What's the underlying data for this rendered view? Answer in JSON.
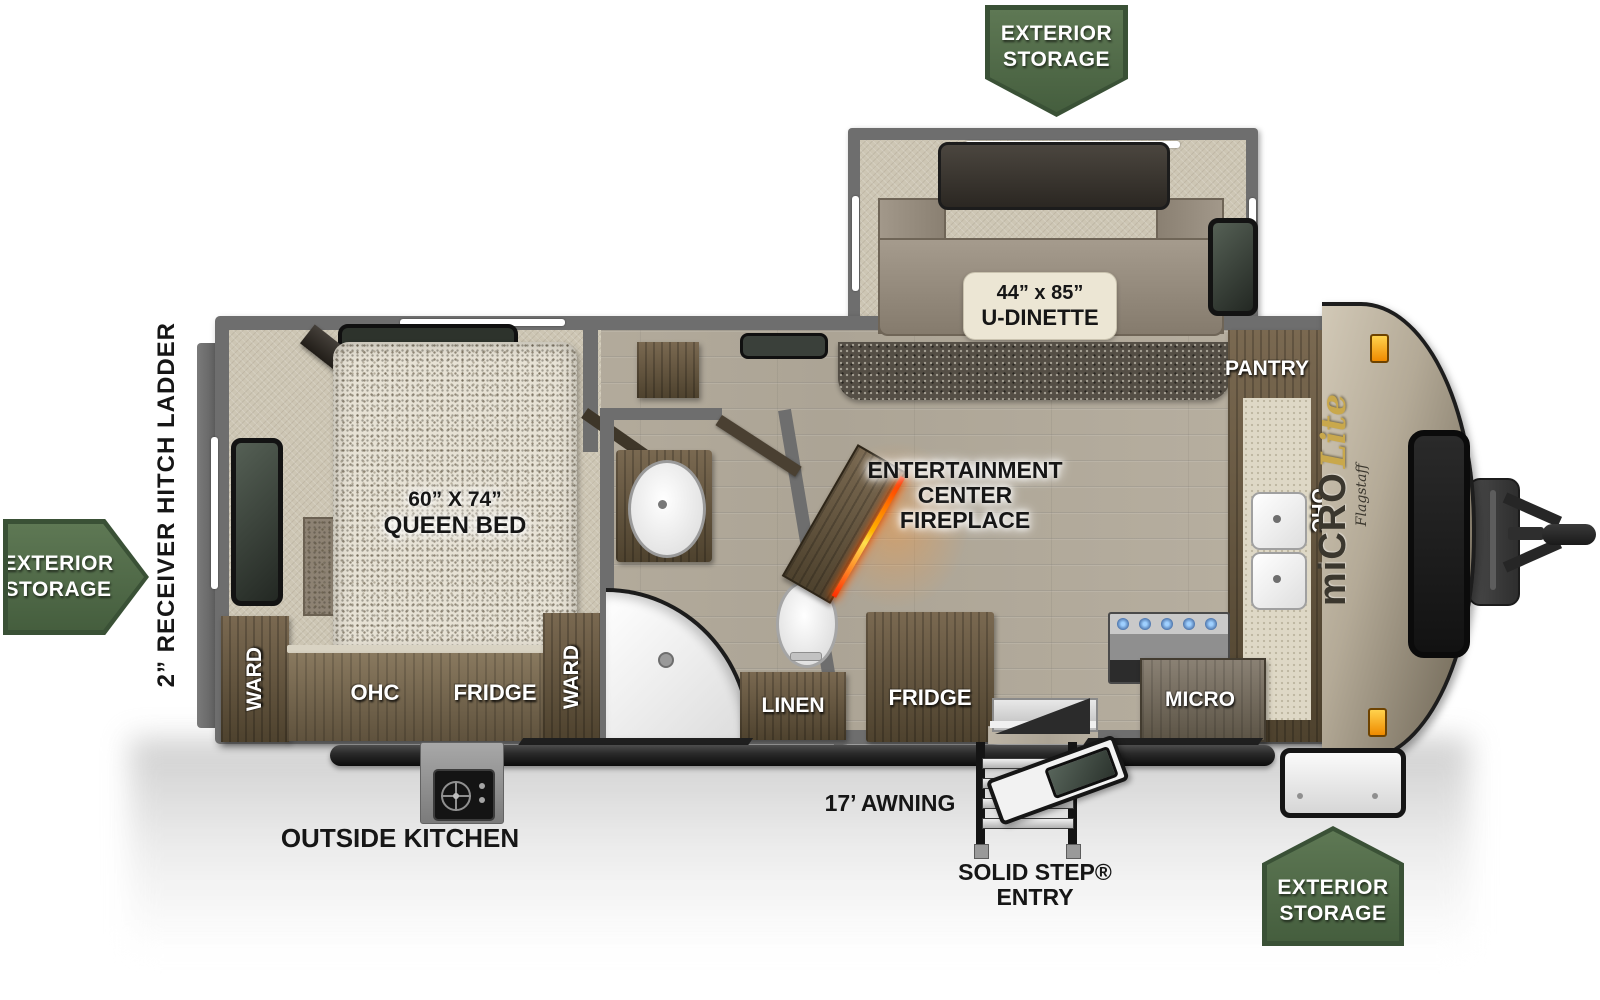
{
  "badges": {
    "top": {
      "line1": "EXTERIOR",
      "line2": "STORAGE"
    },
    "left": {
      "line1": "EXTERIOR",
      "line2": "STORAGE"
    },
    "bottom": {
      "line1": "EXTERIOR",
      "line2": "STORAGE"
    }
  },
  "exterior": {
    "rear_features": "2” RECEIVER HITCH   LADDER",
    "outside_kitchen": "OUTSIDE KITCHEN",
    "awning": "17’ AWNING",
    "entry_line1": "SOLID STEP®",
    "entry_line2": "ENTRY"
  },
  "brand": {
    "model": "miCRO",
    "make": "Flagstaff",
    "trim": "Lite"
  },
  "dinette": {
    "size": "44” x 85”",
    "name": "U-DINETTE"
  },
  "bedroom": {
    "tv": "TV",
    "tv_note": "(OPTIONAL)",
    "bed_size": "60” X 74”",
    "bed_name": "QUEEN BED",
    "ward_left": "WARD",
    "ward_right": "WARD",
    "ohc": "OHC",
    "fridge": "FRIDGE"
  },
  "bath": {
    "linen": "LINEN"
  },
  "living": {
    "ent1": "ENTERTAINMENT",
    "ent2": "CENTER",
    "ent3": "FIREPLACE",
    "fridge": "FRIDGE"
  },
  "kitchen": {
    "pantry": "PANTRY",
    "ohc": "OHC",
    "micro": "MICRO"
  },
  "colors": {
    "badge_green": "#50694a",
    "badge_green_dark": "#3a5136",
    "wall_gray": "#6e6e6e",
    "accent_fire": "#ff4a00",
    "amber_light": "#f29100"
  }
}
